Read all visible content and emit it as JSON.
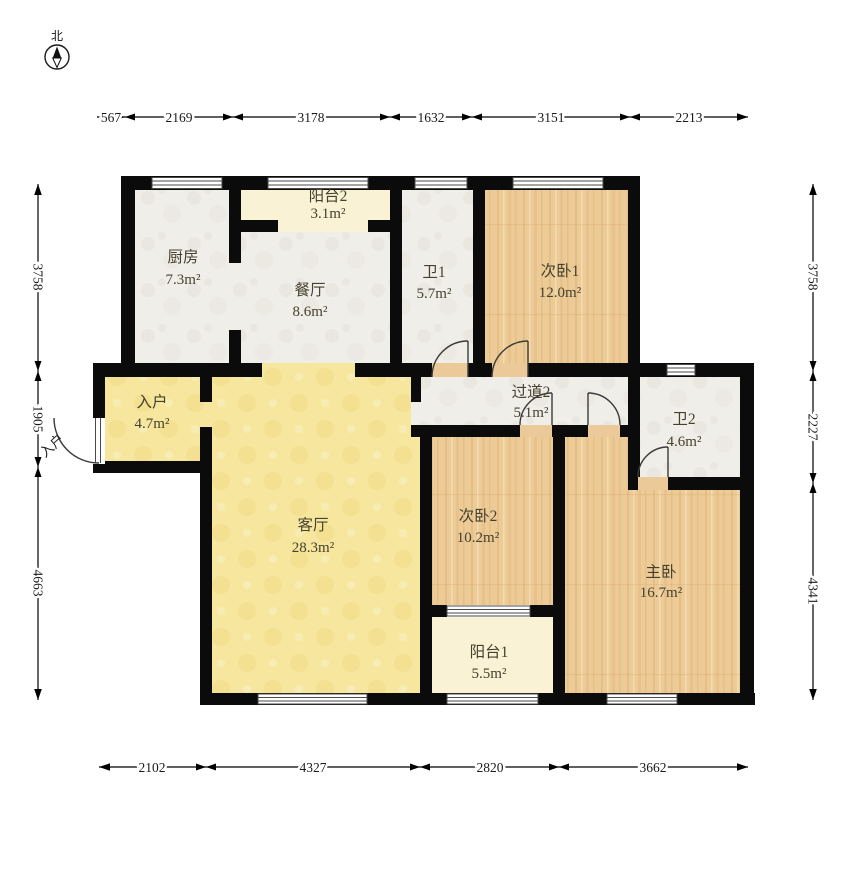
{
  "compass": {
    "north_label": "北"
  },
  "entry_door_label": "入户",
  "rooms": [
    {
      "id": "kitchen",
      "name": "厨房",
      "area": "7.3m²"
    },
    {
      "id": "balcony2",
      "name": "阳台2",
      "area": "3.1m²"
    },
    {
      "id": "dining",
      "name": "餐厅",
      "area": "8.6m²"
    },
    {
      "id": "bath1",
      "name": "卫1",
      "area": "5.7m²"
    },
    {
      "id": "bedroom1",
      "name": "次卧1",
      "area": "12.0m²"
    },
    {
      "id": "entry",
      "name": "入户",
      "area": "4.7m²"
    },
    {
      "id": "hallway2",
      "name": "过道2",
      "area": "5.1m²"
    },
    {
      "id": "bath2",
      "name": "卫2",
      "area": "4.6m²"
    },
    {
      "id": "living",
      "name": "客厅",
      "area": "28.3m²"
    },
    {
      "id": "bedroom2",
      "name": "次卧2",
      "area": "10.2m²"
    },
    {
      "id": "master",
      "name": "主卧",
      "area": "16.7m²"
    },
    {
      "id": "balcony1",
      "name": "阳台1",
      "area": "5.5m²"
    }
  ],
  "dimensions": {
    "top": [
      "567",
      "2169",
      "3178",
      "1632",
      "3151",
      "2213"
    ],
    "bottom": [
      "2102",
      "4327",
      "2820",
      "3662"
    ],
    "left": [
      "3758",
      "1905",
      "4663"
    ],
    "right": [
      "3758",
      "2227",
      "4341"
    ]
  },
  "colors": {
    "wall": "#0b0b0b",
    "wood_floor": "#eccb97",
    "living_floor": "#f6e69e",
    "tile_floor": "#f0eee9",
    "balcony_floor": "#f9f2d4"
  }
}
